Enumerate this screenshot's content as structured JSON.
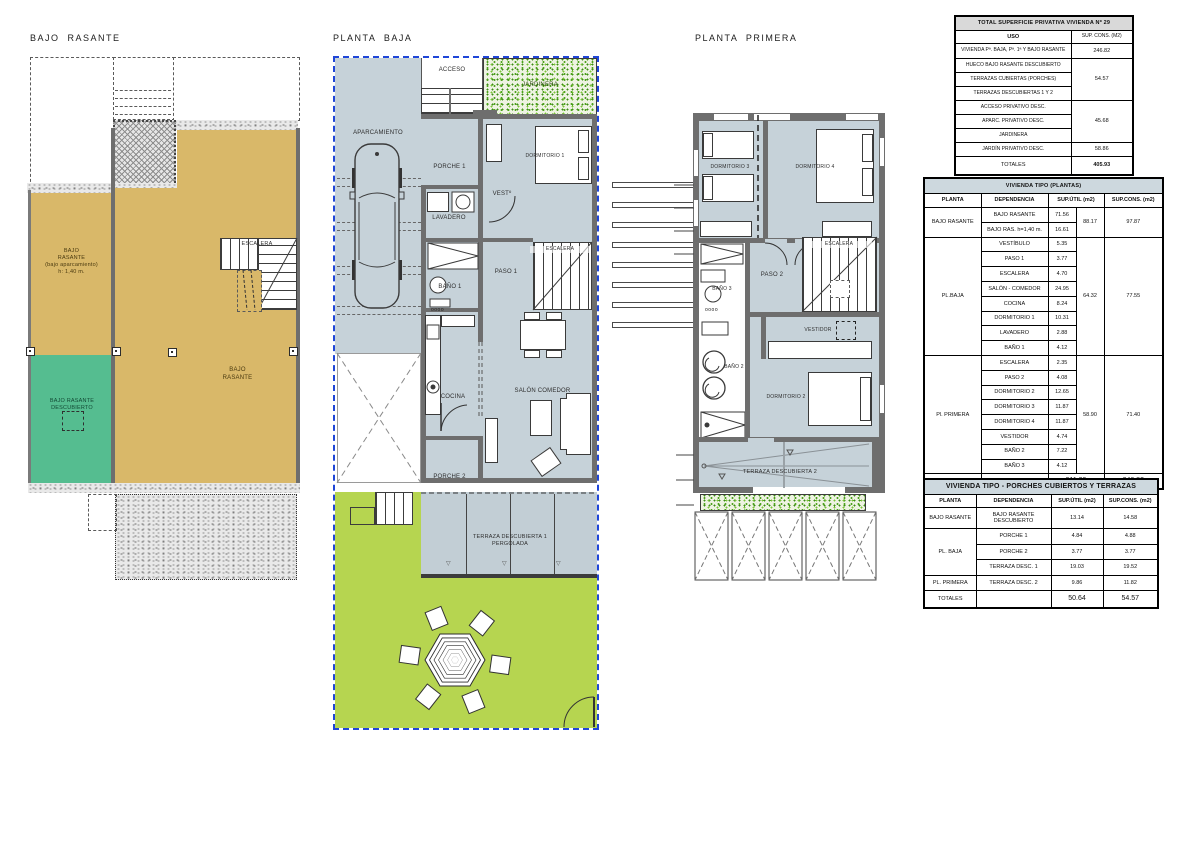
{
  "titles": {
    "bajo_rasante": "BAJO  RASANTE",
    "planta_baja": "PLANTA  BAJA",
    "planta_primera": "PLANTA  PRIMERA"
  },
  "bajo_rasante": {
    "bajo_label": "BAJO\nRASANTE\n(bajo aparcamiento)\nh: 1,40 m.",
    "main_label": "BAJO\nRASANTE",
    "descubierto_label": "BAJO RASANTE\nDESCUBIERTO",
    "escalera": "ESCALERA"
  },
  "planta_baja": {
    "acceso": "ACCESO",
    "jardinera": "JARDINERA",
    "aparcamiento": "APARCAMIENTO",
    "porche1": "PORCHE 1",
    "dormitorio1": "DORMITORIO 1",
    "vest": "VESTº",
    "lavadero": "LAVADERO",
    "bano1": "BAÑO 1",
    "paso1": "PASO 1",
    "escalera": "ESCALERA",
    "cocina": "COCINA",
    "salon": "SALÓN COMEDOR",
    "porche2": "PORCHE 2",
    "terraza1": "TERRAZA DESCUBIERTA 1\nPERGOLADA"
  },
  "planta_primera": {
    "dormitorio3": "DORMITORIO 3",
    "dormitorio4": "DORMITORIO 4",
    "bano3": "BAÑO 3",
    "paso2": "PASO 2",
    "escalera": "ESCALERA",
    "vestidor": "VESTIDOR",
    "bano2": "BAÑO 2",
    "dormitorio2": "DORMITORIO 2",
    "terraza2": "TERRAZA DESCUBIERTA 2"
  },
  "colors": {
    "tan": "#d9b869",
    "teal_green": "#55bd90",
    "plan_fill": "#c6d2d9",
    "wall": "#6e6e6e",
    "garden": "#b6d550",
    "dash_blue": "#1f46d8"
  },
  "table_privativa": {
    "title": "TOTAL SUPERFICIE PRIVATIVA VIVIENDA Nº 29",
    "col_uso": "USO",
    "col_sup": "SUP. CONS. (M2)",
    "r1_uso": "VIVIENDA Pª. BAJA, Pª. 1ª Y BAJO RASANTE",
    "r1_val": "246.82",
    "r2_uso": "HUECO BAJO RASANTE DESCUBIERTO",
    "r3_uso": "TERRAZAS CUBIERTAS (PORCHES)",
    "r4_uso": "TERRAZAS DESCUBIERTAS 1 Y 2",
    "g1_val": "54.57",
    "r5_uso": "ACCESO PRIVATIVO DESC.",
    "r6_uso": "APARC. PRIVATIVO DESC.",
    "r7_uso": "JARDINERA",
    "g2_val": "45.68",
    "r8_uso": "JARDÍN PRIVATIVO  DESC.",
    "r8_val": "58.86",
    "tot_label": "TOTALES",
    "tot_val": "405.93"
  },
  "table_plantas": {
    "title": "VIVIENDA TIPO  (PLANTAS)",
    "h_planta": "PLANTA",
    "h_dep": "DEPENDENCIA",
    "h_util": "SUP.ÚTIL (m2)",
    "h_cons": "SUP.CONS. (m2)",
    "g1_planta": "BAJO RASANTE",
    "g1_rooms": [
      [
        "BAJO RASANTE",
        "71.56"
      ],
      [
        "BAJO RAS. h=1,40 m.",
        "16.61"
      ]
    ],
    "g1_sub": "88.17",
    "g1_cons": "97.87",
    "g2_planta": "PL.BAJA",
    "g2_rooms": [
      [
        "VESTÍBULO",
        "5.35"
      ],
      [
        "PASO 1",
        "3.77"
      ],
      [
        "ESCALERA",
        "4.70"
      ],
      [
        "SALÓN - COMEDOR",
        "24.95"
      ],
      [
        "COCINA",
        "8.24"
      ],
      [
        "DORMITORIO 1",
        "10.31"
      ],
      [
        "LAVADERO",
        "2.88"
      ],
      [
        "BAÑO 1",
        "4.12"
      ]
    ],
    "g2_sub": "64.32",
    "g2_cons": "77.55",
    "g3_planta": "Pl. PRIMERA",
    "g3_rooms": [
      [
        "ESCALERA",
        "2.35"
      ],
      [
        "PASO 2",
        "4.08"
      ],
      [
        "DORMITORIO 2",
        "12.65"
      ],
      [
        "DORMITORIO 3",
        "11.87"
      ],
      [
        "DORMITORIO 4",
        "11.87"
      ],
      [
        "VESTIDOR",
        "4.74"
      ],
      [
        "BAÑO 2",
        "7.22"
      ],
      [
        "BAÑO 3",
        "4.12"
      ]
    ],
    "g3_sub": "58.90",
    "g3_cons": "71.40",
    "tot_label": "TOTALES",
    "tot_util": "211.39",
    "tot_cons": "246.82"
  },
  "table_porches": {
    "title": "VIVIENDA TIPO  - PORCHES CUBIERTOS Y TERRAZAS",
    "h_planta": "PLANTA",
    "h_dep": "DEPENDENCIA",
    "h_util": "SUP.ÚTIL (m2)",
    "h_cons": "SUP.CONS. (m2)",
    "r1_planta": "BAJO  RASANTE",
    "r1_dep": "BAJO RASANTE\nDESCUBIERTO",
    "r1_util": "13.14",
    "r1_cons": "14.58",
    "g_planta": "PL. BAJA",
    "r2_dep": "PORCHE 1",
    "r2_util": "4.84",
    "r2_cons": "4.88",
    "r3_dep": "PORCHE 2",
    "r3_util": "3.77",
    "r3_cons": "3.77",
    "r4_dep": "TERRAZA DESC. 1",
    "r4_util": "19.03",
    "r4_cons": "19.52",
    "r5_planta": "PL. PRIMERA",
    "r5_dep": "TERRAZA DESC. 2",
    "r5_util": "9.86",
    "r5_cons": "11.82",
    "tot_label": "TOTALES",
    "tot_util": "50.64",
    "tot_cons": "54.57"
  }
}
